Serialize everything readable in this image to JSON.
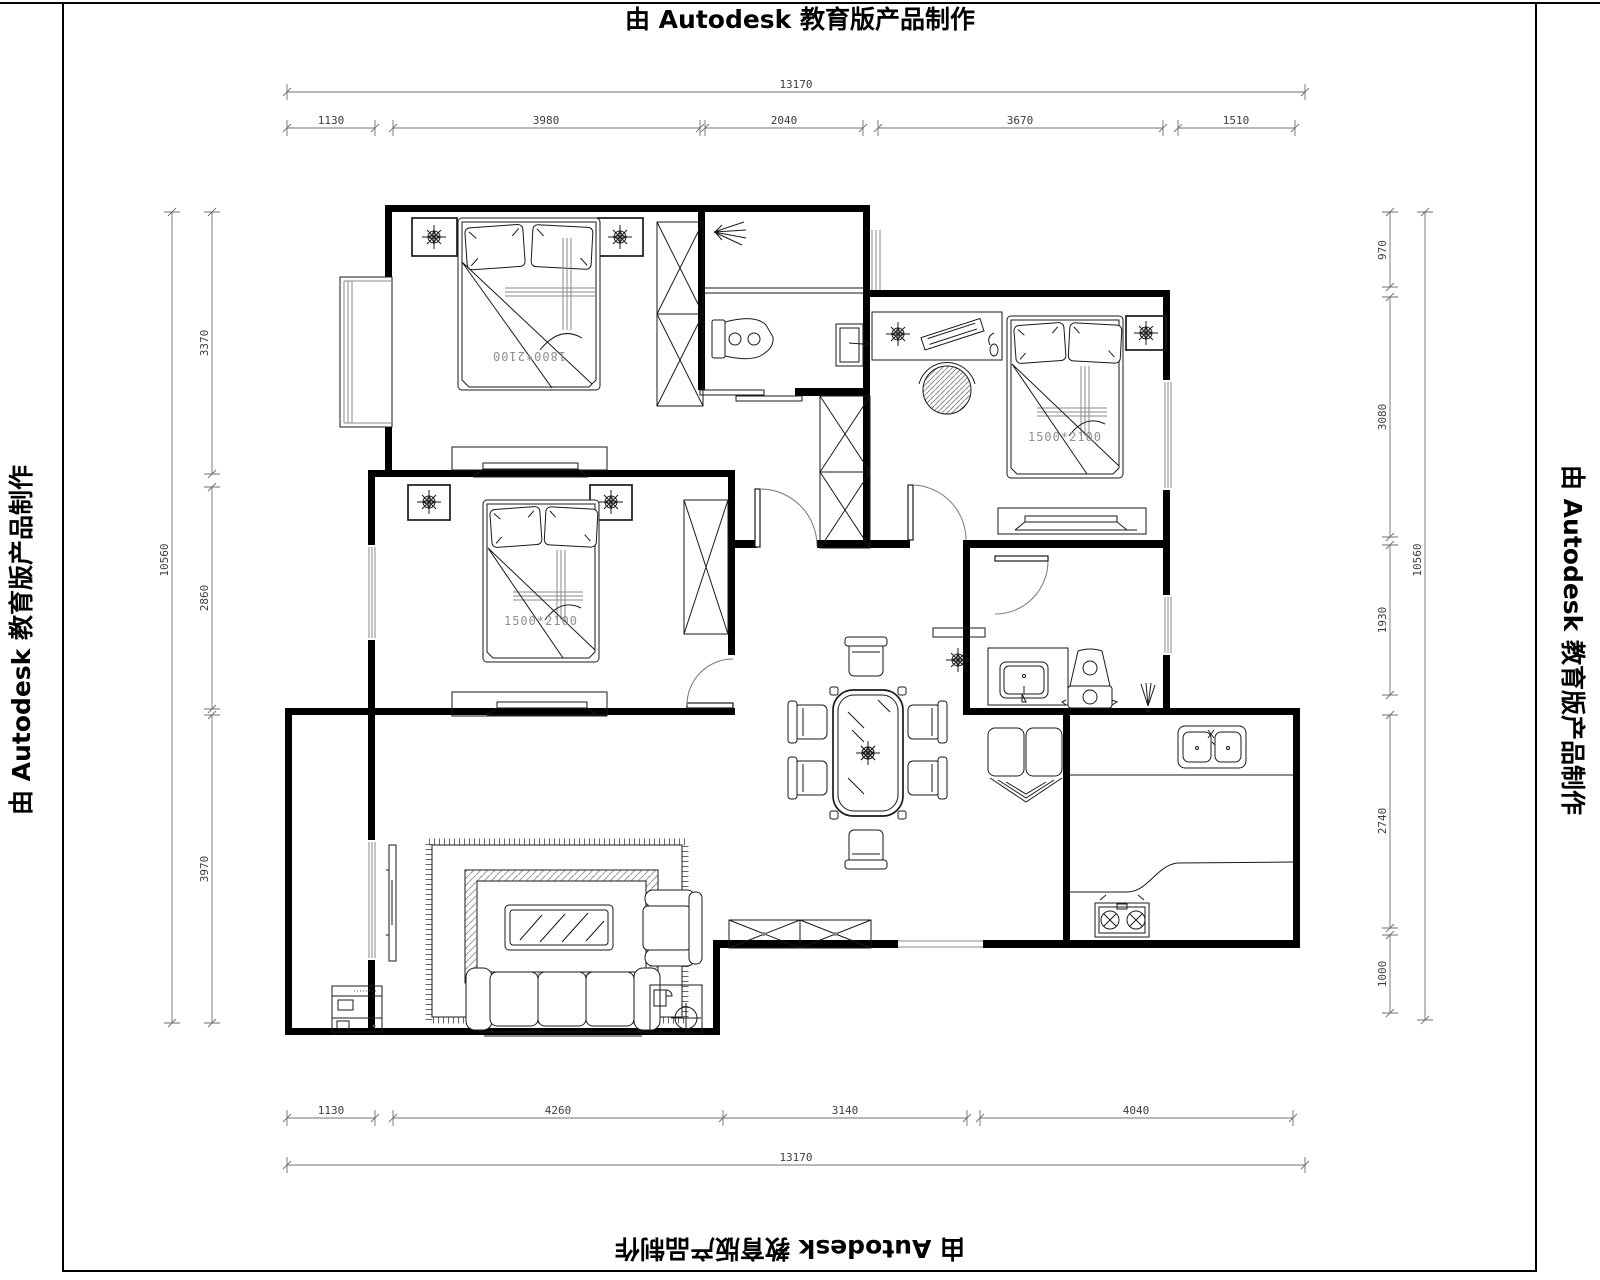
{
  "banners": {
    "top": "由 Autodesk 教育版产品制作",
    "bottom": "由 Autodesk 教育版产品制作",
    "left": "由 Autodesk 教育版产品制作",
    "right": "由 Autodesk 教育版产品制作"
  },
  "labels": {
    "bed_master": "1800*2100",
    "bed_second": "1500*2100",
    "bed_third": "1500*2100"
  },
  "dimensions": {
    "top": {
      "overall": "13170",
      "segments": [
        "1130",
        "3980",
        "2040",
        "3670",
        "1510"
      ]
    },
    "bottom": {
      "overall": "13170",
      "segments": [
        "1130",
        "4260",
        "3140",
        "4040"
      ]
    },
    "left": {
      "overall": "10560",
      "segments": [
        "3370",
        "2860",
        "3970"
      ]
    },
    "right": {
      "overall": "10560",
      "segments": [
        "970",
        "3080",
        "1930",
        "2740",
        "1000"
      ]
    }
  },
  "colors": {
    "walls": "#000000",
    "dimension_lines": "#707070",
    "furniture_lines": "#1a1a1a",
    "bed_label_text": "#8f8f8f"
  },
  "icons": {
    "nightstand_decor": "compass-flower",
    "table_centerpiece": "flower-star",
    "shower": "spray-fan",
    "floor_drain": "fan-lines",
    "table_lamp": "circle-crosshair",
    "plant": "flower-star"
  }
}
